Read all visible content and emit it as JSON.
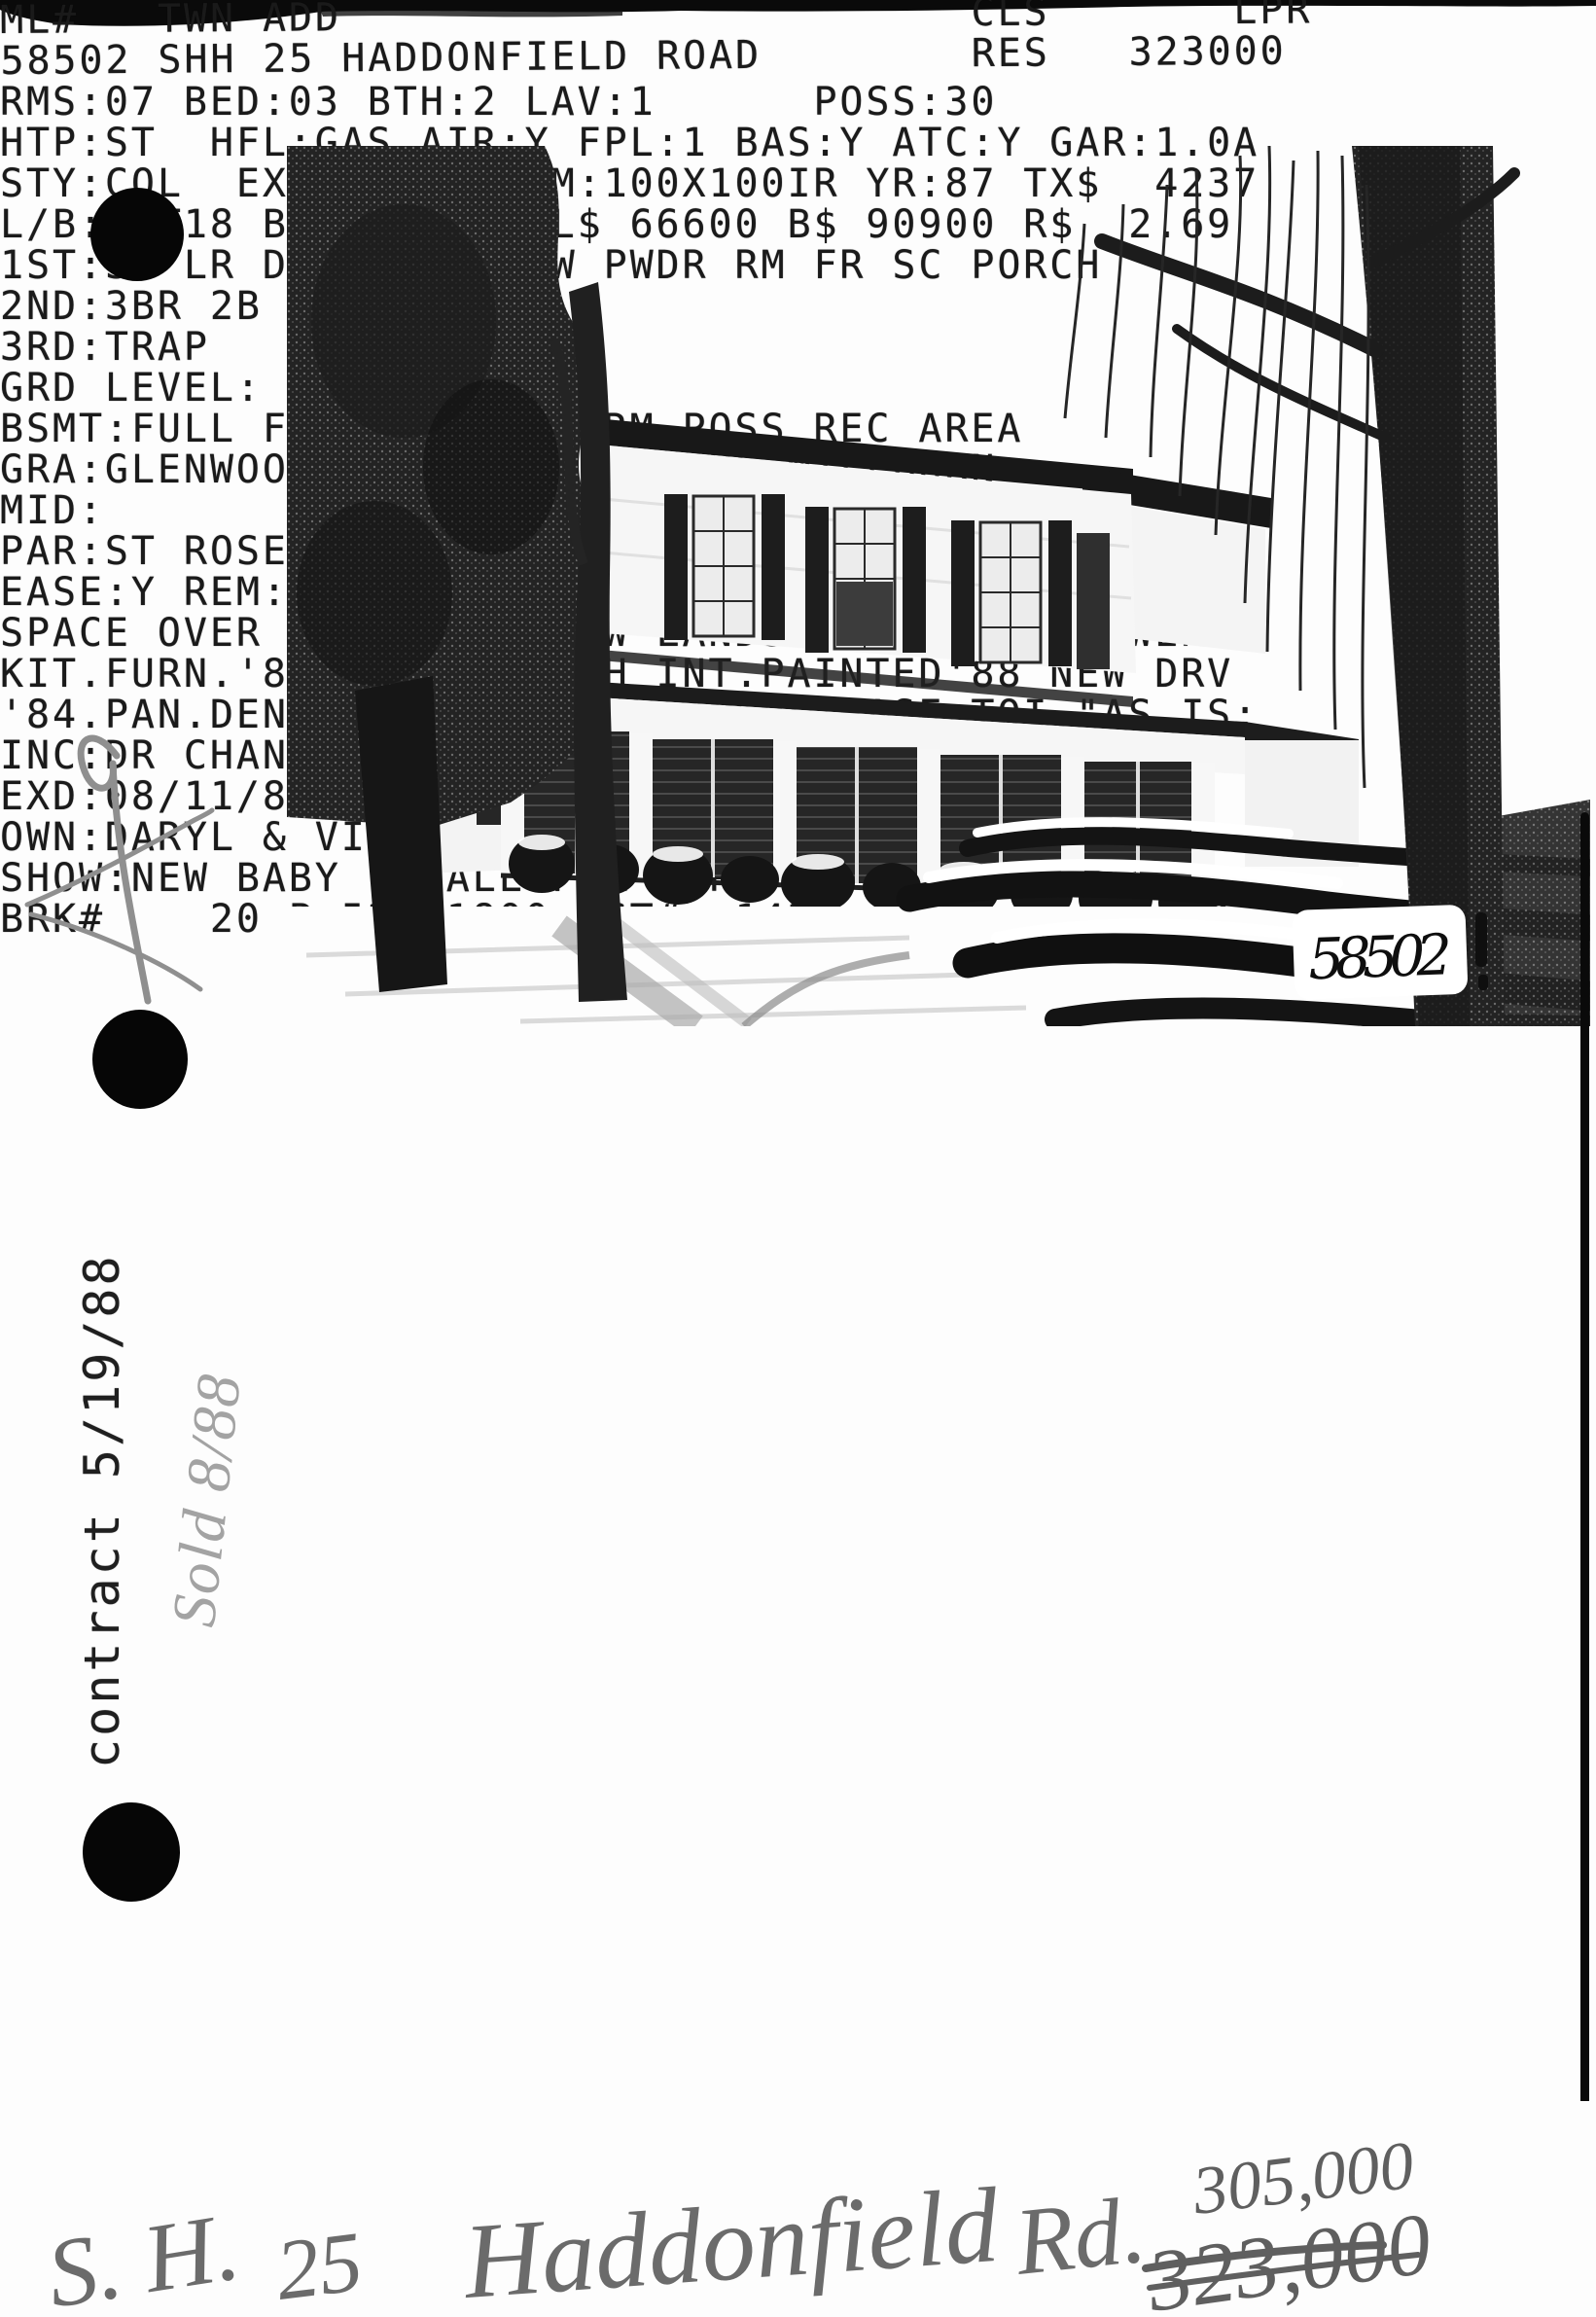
{
  "header": {
    "row1": "ML#   TWN ADD                        CLS       LPR",
    "row2": "58502 SHH 25 HADDONFIELD ROAD        RES   323000",
    "fields": {
      "ml_number": "58502",
      "town": "SHH",
      "address": "25 HADDONFIELD ROAD",
      "class": "RES",
      "list_price": "323000"
    }
  },
  "photo": {
    "corner_label": "58502"
  },
  "listing": {
    "lines": [
      "RMS:07 BED:03 BTH:2 LAV:1      POSS:30",
      "HTP:ST  HFL:GAS AIR:Y FPL:1 BAS:Y ATC:Y GAR:1.0A",
      "STY:COL  EXT:FRAME DIM:100X100IR YR:87 TX$  4237",
      "L/B:LOT18 B1201 ASMT L$ 66600 B$ 90900 R$  2.69",
      "1ST:SH LR DR KIT/EI/DW PWDR RM FR SC PORCH",
      "2ND:3BR 2B",
      "3RD:TRAP",
      "GRD LEVEL:",
      "BSMT:FULL FUR.RM LAUND.RM POSS REC AREA",
      "GRA:GLENWOOD              JHS:MILLBURN",
      "MID:                      HSC:MILLBURN",
      "PAR:ST ROSE               TER:",
      "EASE:Y REM:CHARM.DUT.COL-MOVE-IN COND.LGE.STOR.",
      "SPACE OVER GAR.EXPAN.NEW LANDSC.NEW C/AC NEWER",
      "KIT.FURN.'81 NEW TILE-SH INT.PAINTED'88 NEW DRV",
      "'84.PAN.DEN/ENT.CTR ADD'L INSUL.BASE.TOI.\"AS IS:",
      "INC:DR CHAND.W/W WHERE INST.EXC:WIN.TRT/GIRLS'BR",
      "EXD:08/11/88 LID:02/11/88 KEY:LR & SH OFFICE",
      "OWN:DARYL & VIRGINIA BOFFARD 379-7934",
      "SHOW:NEW BABY - CALL FOR APPT",
      "BRK#    20 P:522-1800 AGT#  1426  CB:2.75 - $50"
    ]
  },
  "annotations": {
    "left_margin_typed": "contract 5/19/88",
    "left_margin_handwritten": "Sold 8/88",
    "bottom": {
      "part1": "S. H.",
      "part2": "25",
      "part3": "Haddonfield",
      "part4": "Rd.",
      "price_new": "305,000",
      "price_crossed_out": "323,000"
    }
  },
  "colors": {
    "ink": "#1a1a1a",
    "pencil": "#8f8f8f",
    "handwriting": "#666666",
    "paper": "#fdfdfd"
  }
}
